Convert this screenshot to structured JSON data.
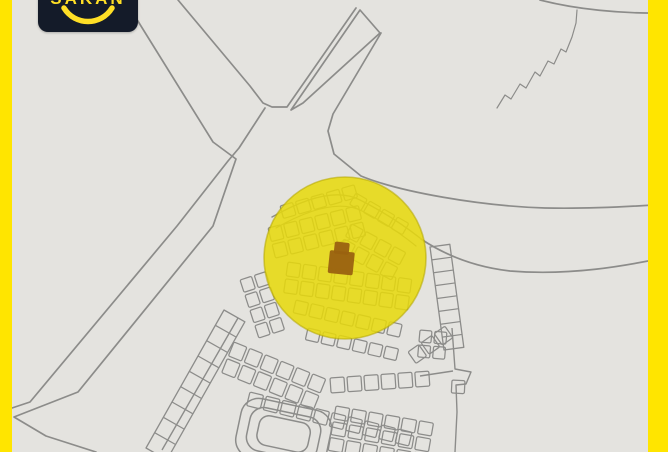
{
  "logo": {
    "text": "SAKAN",
    "icon": "smile-arc-icon"
  },
  "colors": {
    "accent_yellow": "#FFE500",
    "highlight_yellow": "#E8D909",
    "marker_brown": "#9A6210",
    "paper": "#E4E3DF",
    "map_line": "#8C8C8A",
    "logo_bg": "#141B29",
    "logo_yellow": "#FFDF26"
  },
  "map": {
    "description": "scanned cadastral plot map with highlighted location",
    "roads": [
      {
        "name": "road-west-edge",
        "points": "136,18 213,142 236,159 213,226 78,392 14,417 46,436 96,452"
      },
      {
        "name": "road-southwest-edge",
        "points": "265,108 239,148 228,161 177,226 30,402 12,408"
      },
      {
        "name": "road-junction-v",
        "points": "178,0 250,86 263,103 272,107 287,107 356,8"
      },
      {
        "name": "road-median-strip",
        "points": "360,10 380,33 303,103 291,110",
        "closed": true
      }
    ],
    "paths": [
      {
        "name": "road-east-north-edge",
        "d": "M381,33 L333,114 L328,131 L334,154 L361,176 C400,192 480,206 545,208 C590,209 640,206 668,204"
      },
      {
        "name": "road-east-south-edge",
        "d": "M421,239 C445,255 475,267 510,271 C570,276 625,266 668,257"
      },
      {
        "name": "corner-curve",
        "d": "M540,0 C575,9 620,14 668,13"
      },
      {
        "name": "wadi-squiggle",
        "d": "M497,108 L505,95 L511,99 L520,84 L526,88 L535,72 L540,76 L548,61 L554,64 L561,49 L566,52 L572,37 L576,23 L577,10",
        "w": 1.2
      },
      {
        "name": "block-arc-band",
        "d": "M272,217 Q330,184 360,200 Q392,216 420,238",
        "w": 1.4
      },
      {
        "name": "block-arc-band-inner",
        "d": "M276,228 Q332,196 362,211 Q390,225 416,246",
        "w": 1.2
      }
    ],
    "boundaries": [
      {
        "name": "block-east-boundary",
        "points": "452,328 455,369 471,372 466,384 456,385 457,412 455,452"
      },
      {
        "name": "block-divider",
        "points": "420,376 453,371"
      },
      {
        "name": "street-along-road",
        "points": "238,318 162,450"
      }
    ],
    "plot_strips": [
      {
        "name": "plot-grid",
        "x": 280,
        "y": 206,
        "rot": -16,
        "rows": 1,
        "cols": 5,
        "cw": 13,
        "ch": 13,
        "gap": 3
      },
      {
        "name": "plot-grid",
        "x": 356,
        "y": 193,
        "rot": 30,
        "rows": 1,
        "cols": 4,
        "cw": 13,
        "ch": 13,
        "gap": 3
      },
      {
        "name": "plot-grid",
        "x": 268,
        "y": 228,
        "rot": -14,
        "rows": 2,
        "cols": 6,
        "cw": 13,
        "ch": 14,
        "gap": 3
      },
      {
        "name": "plot-grid",
        "x": 352,
        "y": 224,
        "rot": 28,
        "rows": 2,
        "cols": 4,
        "cw": 13,
        "ch": 14,
        "gap": 3
      },
      {
        "name": "plot-grid",
        "x": 288,
        "y": 262,
        "rot": 8,
        "rows": 2,
        "cols": 8,
        "cw": 13,
        "ch": 14,
        "gap": 3
      },
      {
        "name": "plot-grid",
        "x": 296,
        "y": 300,
        "rot": 13,
        "rows": 1,
        "cols": 7,
        "cw": 13,
        "ch": 13,
        "gap": 3
      },
      {
        "name": "plot-grid",
        "x": 308,
        "y": 328,
        "rot": 13,
        "rows": 1,
        "cols": 6,
        "cw": 13,
        "ch": 12,
        "gap": 3
      },
      {
        "name": "plot-grid",
        "x": 240,
        "y": 280,
        "rot": -18,
        "rows": 4,
        "cols": 2,
        "cw": 12,
        "ch": 13,
        "gap": 3
      },
      {
        "name": "plot-grid",
        "x": 234,
        "y": 342,
        "rot": 22,
        "rows": 2,
        "cols": 6,
        "cw": 14,
        "ch": 15,
        "gap": 3
      },
      {
        "name": "plot-grid",
        "x": 330,
        "y": 378,
        "rot": -4,
        "rows": 1,
        "cols": 6,
        "cw": 14,
        "ch": 15,
        "gap": 3
      },
      {
        "name": "plot-grid",
        "x": 408,
        "y": 352,
        "rot": -35,
        "rows": 1,
        "cols": 3,
        "cw": 13,
        "ch": 14,
        "gap": 3
      },
      {
        "name": "plot-grid",
        "x": 250,
        "y": 392,
        "rot": 14,
        "rows": 1,
        "cols": 10,
        "cw": 14,
        "ch": 14,
        "gap": 3
      },
      {
        "name": "plot-grid",
        "x": 336,
        "y": 406,
        "rot": 10,
        "rows": 3,
        "cols": 6,
        "cw": 14,
        "ch": 13,
        "gap": 3
      },
      {
        "name": "plot-grid",
        "x": 420,
        "y": 330,
        "rot": 5,
        "rows": 2,
        "cols": 2,
        "cw": 12,
        "ch": 12,
        "gap": 3
      },
      {
        "name": "plot-grid",
        "x": 452,
        "y": 380,
        "rot": 3,
        "rows": 1,
        "cols": 1,
        "cw": 13,
        "ch": 13,
        "gap": 3
      }
    ],
    "ladders": [
      {
        "name": "plot-ladder-southwest",
        "x1": 224,
        "y1": 310,
        "x2": 146,
        "y2": 448,
        "w": 24,
        "n": 9
      },
      {
        "name": "plot-ladder-east",
        "x1": 430,
        "y1": 247,
        "x2": 444,
        "y2": 350,
        "w": 20,
        "n": 8
      }
    ],
    "compound": {
      "name": "compound-outline",
      "cx": 284,
      "cy": 432,
      "rot": 12,
      "rings": [
        [
          238,
          404,
          92,
          60,
          18
        ],
        [
          248,
          412,
          72,
          44,
          14
        ],
        [
          258,
          419,
          52,
          30,
          10
        ]
      ]
    },
    "highlight_circle": {
      "name": "highlight-circle",
      "cx": 345,
      "cy": 258,
      "r": 81,
      "opacity": 0.85
    },
    "marker": {
      "name": "property-marker",
      "rot": 6,
      "rects": [
        [
          330,
          250,
          25,
          23
        ],
        [
          334,
          241,
          15,
          12
        ]
      ]
    }
  }
}
